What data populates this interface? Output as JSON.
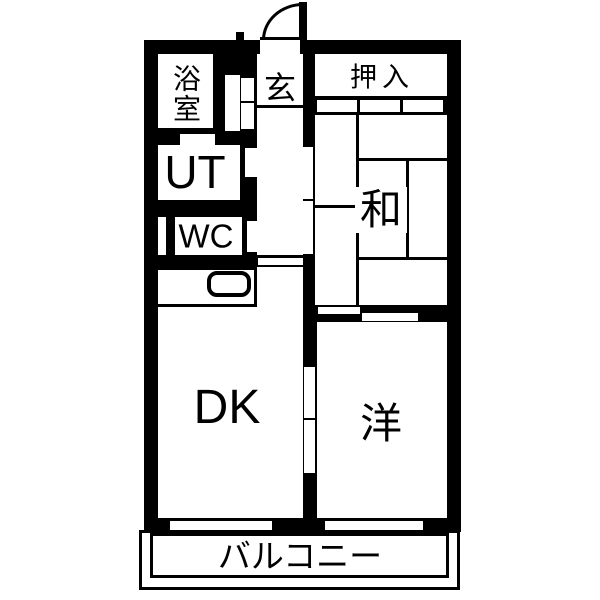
{
  "colors": {
    "ink": "#000000",
    "paper": "#ffffff"
  },
  "rooms": {
    "bath": "浴室",
    "entrance": "玄",
    "closet": "押入",
    "utility": "UT",
    "toilet": "WC",
    "japanese_room": "和",
    "dining_kitchen": "DK",
    "western_room": "洋",
    "balcony": "バルコニー"
  }
}
